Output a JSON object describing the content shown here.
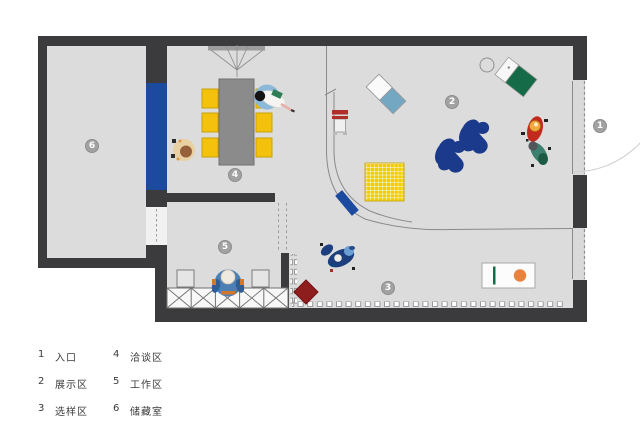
{
  "legend": {
    "items": [
      {
        "num": "1",
        "label": "入口"
      },
      {
        "num": "2",
        "label": "展示区"
      },
      {
        "num": "3",
        "label": "选样区"
      },
      {
        "num": "4",
        "label": "洽谈区"
      },
      {
        "num": "5",
        "label": "工作区"
      },
      {
        "num": "6",
        "label": "储藏室"
      }
    ]
  },
  "plan": {
    "badges": [
      "1",
      "2",
      "3",
      "4",
      "5",
      "6"
    ],
    "colors": {
      "wall": "#3b3b3d",
      "floor": "#dcdcdc",
      "feature_blue": "#1b4a9e",
      "chair_yellow": "#f4c20c",
      "rug_yellow": "#f0cc00",
      "navy_lounge": "#1c3a8c",
      "dark_red": "#8e1d1d",
      "green": "#156a47",
      "orange": "#e8823c",
      "steel_blue": "#74a7c2",
      "badge_gray": "#a2a2a2"
    }
  }
}
